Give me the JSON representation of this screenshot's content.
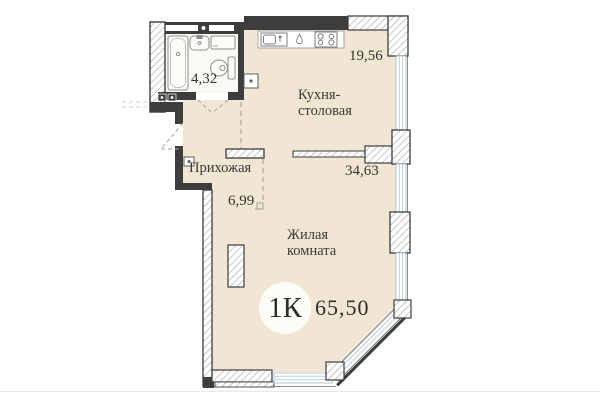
{
  "summary": {
    "plan_type_badge": "1К",
    "total_area": "65,50"
  },
  "rooms": {
    "bathroom": {
      "area": "4,32"
    },
    "kitchen": {
      "label": "Кухня-столовая",
      "area": "19,56"
    },
    "hallway": {
      "label": "Прихожая",
      "area": "6,99"
    },
    "living": {
      "label": "Жилая комната",
      "area": "34,63"
    }
  },
  "icons": [
    "bathtub-icon",
    "washbasin-icon",
    "washing-machine-icon",
    "toilet-icon",
    "kitchen-sink-icon",
    "water-drop-icon",
    "stove-icon",
    "vent-shaft-icon",
    "utility-box-icon",
    "electric-meter-icon",
    "door-swing-icon",
    "window-glazing"
  ],
  "colors": {
    "floor": "#f1e6d3",
    "bathroom_floor": "#fbf9f3",
    "wall": "#3d3d3d",
    "hatch": "#9a9a9a",
    "window": "#b9d3e3",
    "text": "#3a3a3a",
    "badge_bg": "#fdfdf8"
  }
}
